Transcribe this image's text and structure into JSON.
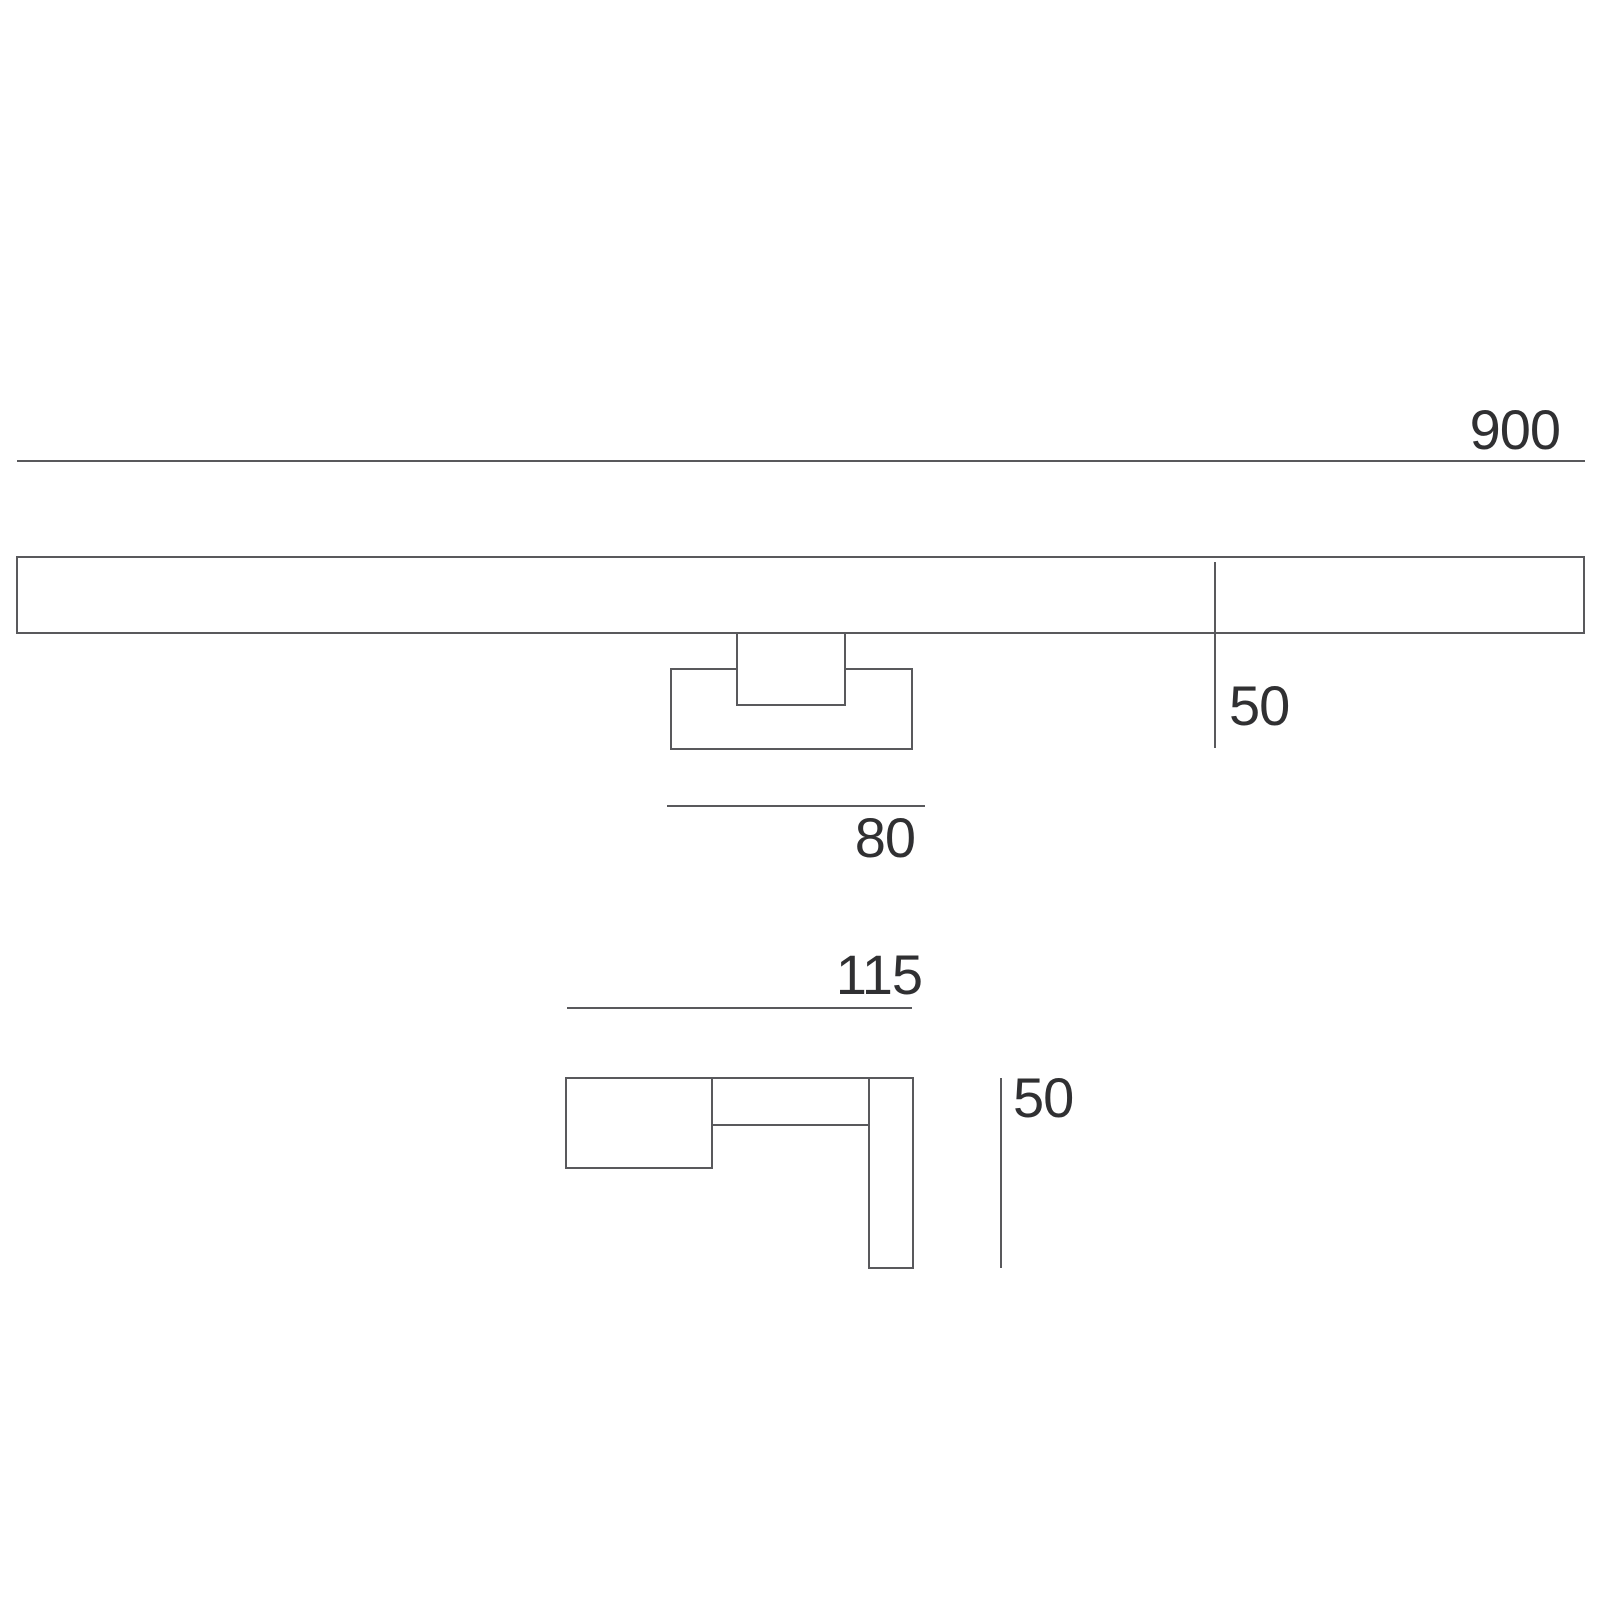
{
  "drawing": {
    "type": "technical-dimension-drawing",
    "views": {
      "front": {
        "width_label": "900",
        "height_label": "50",
        "bracket_width_label": "80"
      },
      "side": {
        "depth_label": "115",
        "height_label": "50"
      }
    },
    "colors": {
      "line": "#59595c",
      "text": "#303032",
      "background": "#ffffff"
    }
  }
}
